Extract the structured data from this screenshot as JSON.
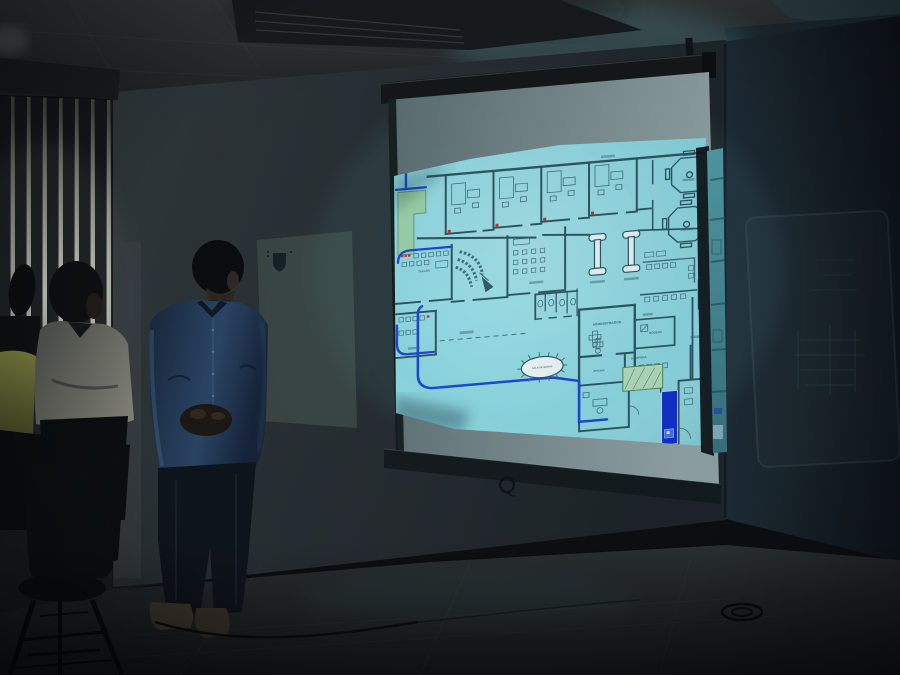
{
  "scene": {
    "setting_label": "darkened meeting room with projected slide",
    "projected_content_label": "architectural floor plan",
    "people": [
      {
        "role": "attendee",
        "position": "far-left",
        "shirt_color_name": "yellow-green"
      },
      {
        "role": "attendee",
        "position": "left",
        "shirt_color_name": "white"
      },
      {
        "role": "presenter",
        "position": "center-left",
        "shirt_color_name": "blue"
      }
    ]
  },
  "plan": {
    "labels": {
      "administrador": "ADMINISTRADOR",
      "bodega": "BODEGA",
      "sala_espera": "S. ESPERA",
      "oficina": "OFICINA",
      "taller": "TALLER",
      "sala_juntas": "SALA DE JUNTAS"
    }
  },
  "colors": {
    "screen_cyan": "#8fdde6",
    "plan_wall": "#2e5863",
    "route_blue": "#1d49d6",
    "green_zone": "#9fd6ac",
    "green_hatch": "#b6e2bf",
    "highlight_blue": "#1030cf",
    "marker_red": "#c23430"
  }
}
